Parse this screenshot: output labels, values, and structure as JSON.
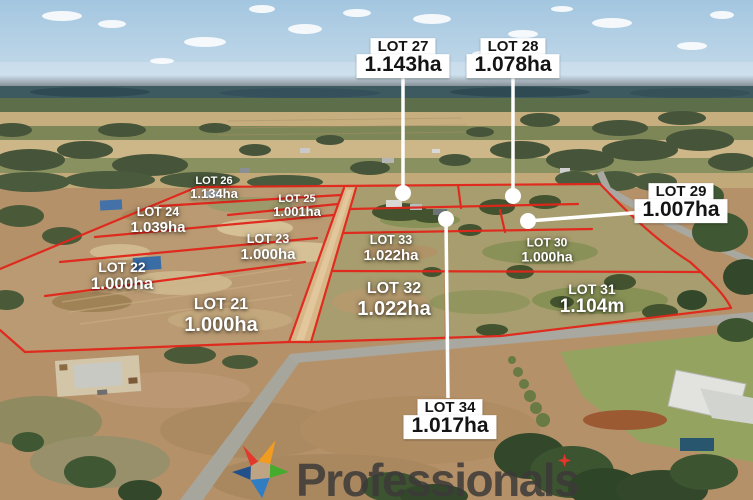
{
  "colors": {
    "boundary": "#e2251a",
    "leader": "#ffffff",
    "label_bg": "#ffffff",
    "label_text": "#141414",
    "ground_label_text": "#ffffff",
    "logo_text_color": "#3c3a38",
    "logo_star": {
      "red": "#e6342a",
      "orange": "#f59e1c",
      "green": "#3fae2a",
      "blue": "#2a7dc8",
      "navy": "#1a4e8d"
    }
  },
  "callouts": [
    {
      "name": "LOT 27",
      "area": "1.143ha"
    },
    {
      "name": "LOT 28",
      "area": "1.078ha"
    },
    {
      "name": "LOT 29",
      "area": "1.007ha"
    },
    {
      "name": "LOT 34",
      "area": "1.017ha"
    }
  ],
  "ground_labels": [
    {
      "name": "LOT 26",
      "area": "1.134ha"
    },
    {
      "name": "LOT 25",
      "area": "1.001ha"
    },
    {
      "name": "LOT 24",
      "area": "1.039ha"
    },
    {
      "name": "LOT 23",
      "area": "1.000ha"
    },
    {
      "name": "LOT 22",
      "area": "1.000ha"
    },
    {
      "name": "LOT 21",
      "area": "1.000ha"
    },
    {
      "name": "LOT 33",
      "area": "1.022ha"
    },
    {
      "name": "LOT 32",
      "area": "1.022ha"
    },
    {
      "name": "LOT 30",
      "area": "1.000ha"
    },
    {
      "name": "LOT 31",
      "area": "1.104m"
    }
  ],
  "logo": {
    "text": "Professionals"
  }
}
